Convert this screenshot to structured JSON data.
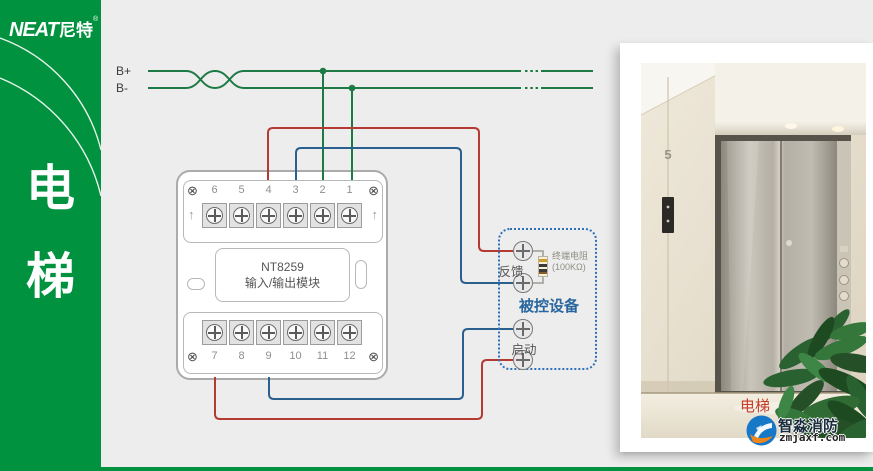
{
  "brand": {
    "name_latin": "NEAT",
    "name_cn": "尼特",
    "reg": "®"
  },
  "sidebar": {
    "title_chars": [
      "电",
      "梯"
    ]
  },
  "bus": {
    "positive": "B+",
    "negative": "B-"
  },
  "module": {
    "model": "NT8259",
    "type": "输入/输出模块",
    "top_terminals": [
      "6",
      "5",
      "4",
      "3",
      "2",
      "1"
    ],
    "bottom_terminals": [
      "7",
      "8",
      "9",
      "10",
      "11",
      "12"
    ]
  },
  "device": {
    "title": "被控设备",
    "feedback": "反馈",
    "start": "启动",
    "resistor_line1": "终端电阻",
    "resistor_line2": "(100KΩ)"
  },
  "photo": {
    "caption": "电梯",
    "floor_indicator": "5"
  },
  "watermark": {
    "brand": "智淼消防",
    "site": "zmjaxf.com"
  },
  "icons": {
    "corner_screw": "⊗",
    "arrow_up": "↑"
  },
  "colors": {
    "sidebar_green": "#00923E",
    "background": "#EDEDED",
    "wire_red": "#B43A32",
    "wire_blue": "#2B5F8E",
    "wire_green": "#1E7A45",
    "device_border": "#2E6FBA",
    "device_title_blue": "#29679E",
    "caption_red": "#C63C28"
  }
}
